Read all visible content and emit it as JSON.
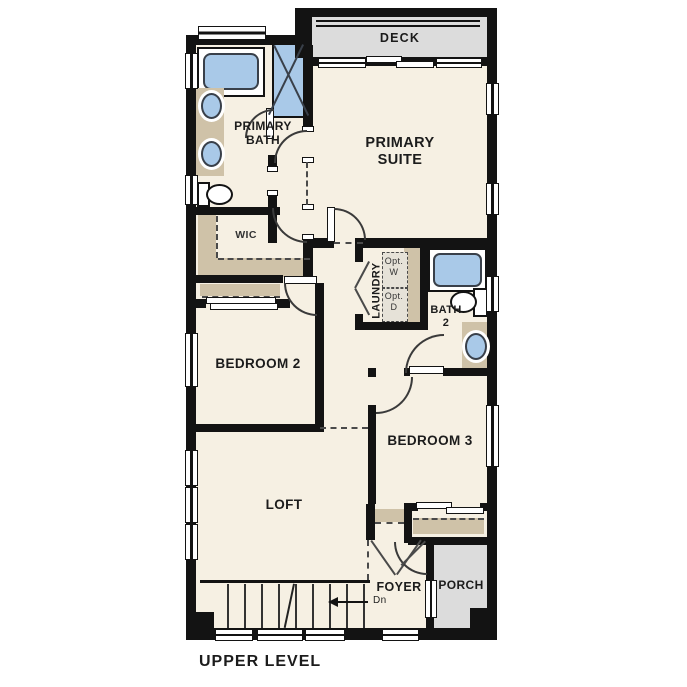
{
  "title": "UPPER LEVEL",
  "colors": {
    "wall": "#131313",
    "floor": "#f6f0e3",
    "fixture_blue": "#a9c9e8",
    "counter_tan": "#cfc2a8",
    "outdoor_gray": "#dcdcdc"
  },
  "rooms": {
    "deck": {
      "label": "DECK"
    },
    "primary_suite": {
      "line1": "PRIMARY",
      "line2": "SUITE"
    },
    "primary_bath": {
      "line1": "PRIMARY",
      "line2": "BATH"
    },
    "wic": {
      "label": "WIC"
    },
    "laundry": {
      "label": "LAUNDRY",
      "opt_washer_line1": "Opt.",
      "opt_washer_line2": "W",
      "opt_dryer_line1": "Opt.",
      "opt_dryer_line2": "D"
    },
    "bath2": {
      "line1": "BATH",
      "line2": "2"
    },
    "bedroom2": {
      "label": "BEDROOM 2"
    },
    "bedroom3": {
      "label": "BEDROOM 3"
    },
    "loft": {
      "label": "LOFT"
    },
    "foyer": {
      "label": "FOYER"
    },
    "porch": {
      "label": "PORCH"
    },
    "stairs": {
      "down_label": "Dn"
    }
  }
}
